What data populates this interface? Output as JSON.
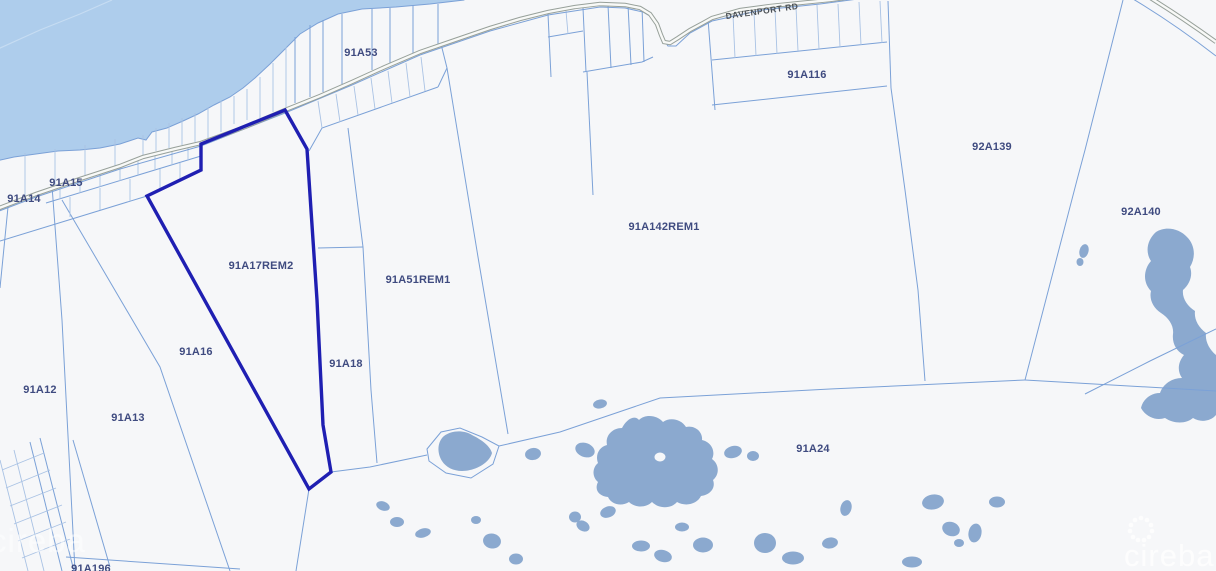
{
  "map": {
    "selected_parcel": "91A17REM2",
    "road_label": {
      "text": "DAVENPORT RD"
    },
    "watermark": {
      "text": "cireba"
    },
    "parcel_labels": [
      {
        "id": "91a53",
        "text": "91A53",
        "x": 361,
        "y": 53
      },
      {
        "id": "91a116",
        "text": "91A116",
        "x": 807,
        "y": 75
      },
      {
        "id": "92a139",
        "text": "92A139",
        "x": 992,
        "y": 147
      },
      {
        "id": "92a140",
        "text": "92A140",
        "x": 1141,
        "y": 212
      },
      {
        "id": "91a142rem1",
        "text": "91A142REM1",
        "x": 664,
        "y": 227
      },
      {
        "id": "91a51rem1",
        "text": "91A51REM1",
        "x": 418,
        "y": 280
      },
      {
        "id": "91a17rem2",
        "text": "91A17REM2",
        "x": 261,
        "y": 266
      },
      {
        "id": "91a16",
        "text": "91A16",
        "x": 196,
        "y": 352
      },
      {
        "id": "91a18",
        "text": "91A18",
        "x": 346,
        "y": 364
      },
      {
        "id": "91a15",
        "text": "91A15",
        "x": 66,
        "y": 183
      },
      {
        "id": "91a14",
        "text": "91A14",
        "x": 24,
        "y": 199
      },
      {
        "id": "91a12",
        "text": "91A12",
        "x": 40,
        "y": 390
      },
      {
        "id": "91a13",
        "text": "91A13",
        "x": 128,
        "y": 418
      },
      {
        "id": "91a24",
        "text": "91A24",
        "x": 813,
        "y": 449
      },
      {
        "id": "91a196",
        "text": "91A196",
        "x": 91,
        "y": 569
      }
    ],
    "colors": {
      "land": "#f6f7f9",
      "sea": "#aecdec",
      "sea_contour": "#c6dcf2",
      "pond": "#8ba9cf",
      "parcel_line": "#7ba1d7",
      "parcel_line_faint": "#a9c2e4",
      "road_casing": "#97a09a",
      "road_fill": "#f8f9f7",
      "highlight": "#1f1fb2",
      "label": "#3f4b80",
      "road_label": "#4b5055",
      "watermark": "#ffffff"
    }
  }
}
